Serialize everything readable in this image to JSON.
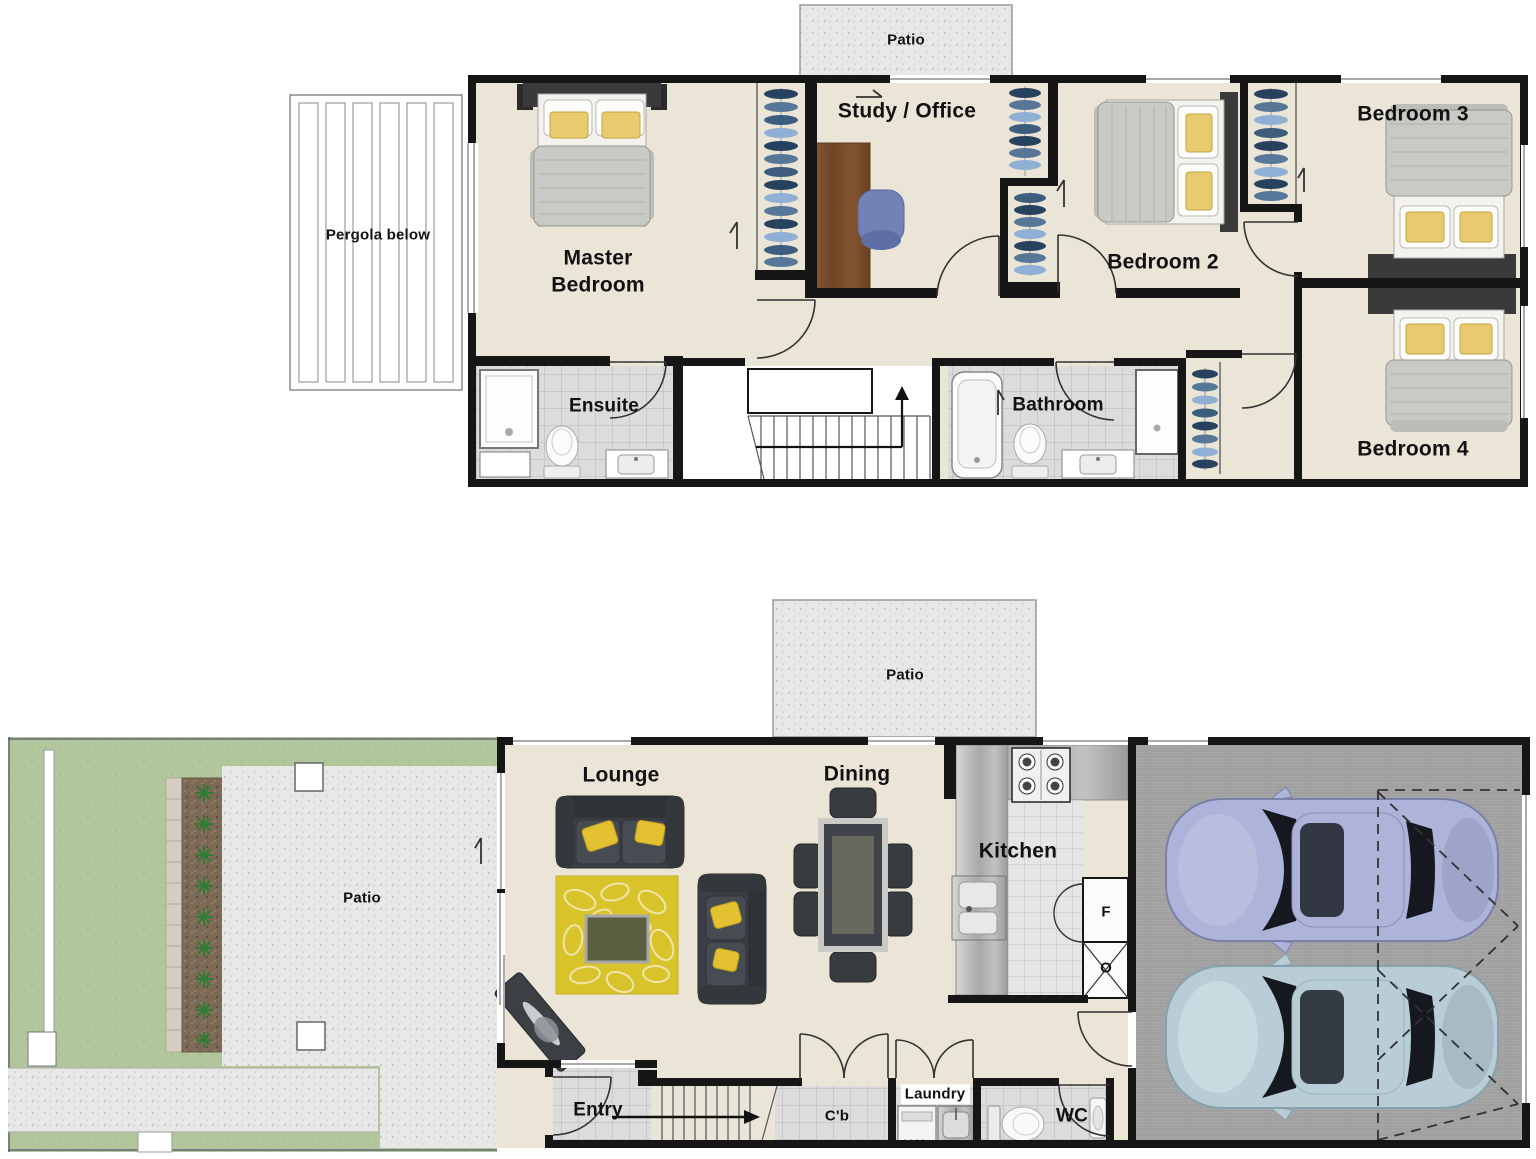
{
  "labels": {
    "upper": {
      "patio": "Patio",
      "pergola": "Pergola below",
      "master": "Master Bedroom",
      "study": "Study / Office",
      "bedroom2": "Bedroom 2",
      "bedroom3": "Bedroom 3",
      "bedroom4": "Bedroom 4",
      "ensuite": "Ensuite",
      "bathroom": "Bathroom"
    },
    "ground": {
      "patio": "Patio",
      "lounge": "Lounge",
      "dining": "Dining",
      "kitchen": "Kitchen",
      "fridge": "F",
      "oven": "O",
      "yard_patio": "Patio",
      "entry": "Entry",
      "cupboard": "C'b",
      "laundry": "Laundry",
      "wc": "WC"
    }
  },
  "colors": {
    "wall": "#161616",
    "floor_beige": "#eae5d6",
    "tile_gray": "#dcdcdc",
    "grass_green": "#b2c69b",
    "concrete": "#e8e8e6",
    "garage_floor": "#a5a5a5",
    "car_lavender": "#aeb3d9",
    "car_blue": "#b9cdd6",
    "rug_yellow": "#d9c32b",
    "sofa_charcoal": "#3f4348",
    "desk_wood": "#7d5231",
    "cushion_yellow": "#e4c131",
    "hanger_blue": "#567798"
  }
}
